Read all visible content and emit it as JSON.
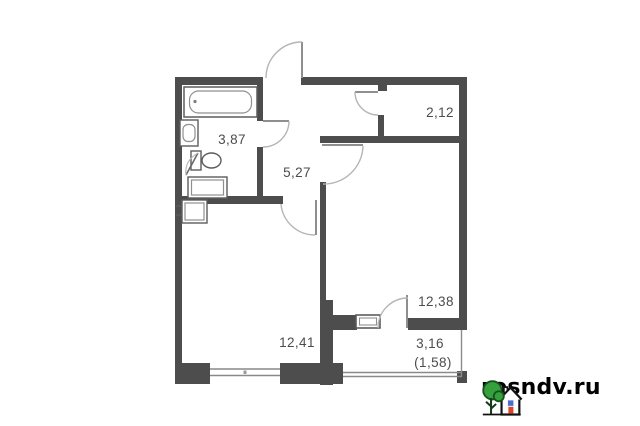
{
  "page": {
    "background": "#ffffff",
    "type": "apartment-floor-plan-photo"
  },
  "floor_plan": {
    "rooms": [
      {
        "id": "bathroom",
        "area": "3,87"
      },
      {
        "id": "storage",
        "area": "2,12"
      },
      {
        "id": "hallway",
        "area": "5,27"
      },
      {
        "id": "living-room",
        "area": "12,38"
      },
      {
        "id": "kitchen-living-room",
        "area": "12,41"
      },
      {
        "id": "balcony",
        "area": "3,16",
        "area_reduced": "(1,58)"
      }
    ],
    "fixtures": [
      "bathtub",
      "wash-basin",
      "toilet",
      "washing-machine",
      "kitchen-sink"
    ],
    "doors": [
      "entrance-door",
      "bathroom-door",
      "storage-door",
      "living-room-door",
      "room-door",
      "balcony-door"
    ],
    "windows": [
      "main-window",
      "balcony-window",
      "balcony-glazing"
    ],
    "colors": {
      "wall": "#4d4d4d",
      "door_leaf": "#9b9b9b",
      "door_arc": "#b5b5b5",
      "fixture_outline": "#5c5c5c",
      "fixture_inner": "#8f8f8f",
      "window_line": "#898989",
      "label_text": "#4c4c4c"
    }
  },
  "watermark": {
    "site": "rosndv.ru",
    "colors": {
      "text": "#000000",
      "tree_fill": "#35a03c",
      "tree_outline": "#16521d",
      "trunk": "#143a1b",
      "house_outline": "#121212",
      "house_window": "#4a6fd0",
      "house_door": "#d9472b"
    }
  }
}
